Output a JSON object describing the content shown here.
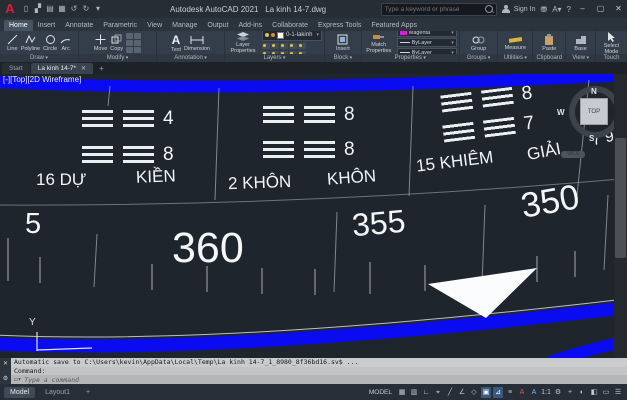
{
  "titlebar": {
    "logo": "A",
    "app_title": "Autodesk AutoCAD 2021",
    "doc_title": "La kinh 14-7.dwg",
    "search_placeholder": "Type a keyword or phrase",
    "sign_in_label": "Sign In",
    "window": {
      "minimize": "–",
      "maximize": "▢",
      "close": "✕"
    },
    "qat_icons": [
      {
        "name": "new-file-icon",
        "glyph": "▯"
      },
      {
        "name": "open-folder-icon",
        "glyph": "▞"
      },
      {
        "name": "save-icon",
        "glyph": "▤"
      },
      {
        "name": "plot-icon",
        "glyph": "▦"
      },
      {
        "name": "undo-icon",
        "glyph": "↺"
      },
      {
        "name": "redo-icon",
        "glyph": "↻"
      },
      {
        "name": "qat-dropdown-icon",
        "glyph": "▾"
      }
    ]
  },
  "ribbon": {
    "tabs": [
      {
        "label": "Home",
        "active": true
      },
      {
        "label": "Insert"
      },
      {
        "label": "Annotate"
      },
      {
        "label": "Parametric"
      },
      {
        "label": "View"
      },
      {
        "label": "Manage"
      },
      {
        "label": "Output"
      },
      {
        "label": "Add-ins"
      },
      {
        "label": "Collaborate"
      },
      {
        "label": "Express Tools"
      },
      {
        "label": "Featured Apps"
      }
    ],
    "draw": {
      "label": "Draw",
      "line": "Line",
      "polyline": "Polyline",
      "circle": "Circle",
      "arc": "Arc"
    },
    "modify": {
      "label": "Modify",
      "move": "Move",
      "copy": "Copy"
    },
    "annotation": {
      "label": "Annotation",
      "text_icon": "A",
      "text": "Text",
      "dimension": "Dimension"
    },
    "layers": {
      "label": "Layers",
      "layer_properties": "Layer Properties",
      "current_layer": "0-1-lakinh"
    },
    "block": {
      "label": "Block",
      "insert": "Insert"
    },
    "properties": {
      "label": "Properties",
      "match": "Match Properties",
      "color": "Magenta",
      "linetype": "ByLayer",
      "lineweight": "ByLayer"
    },
    "groups": {
      "label": "Groups",
      "group": "Group"
    },
    "utilities": {
      "label": "Utilities",
      "measure": "Measure"
    },
    "clipboard": {
      "label": "Clipboard",
      "paste": "Paste"
    },
    "view": {
      "label": "View",
      "base": "Base"
    },
    "touch": {
      "label": "Touch",
      "select": "Select Mode"
    }
  },
  "file_tabs": {
    "start": "Start",
    "document": "La kinh 14-7*",
    "close": "✕",
    "new_tab": "+"
  },
  "canvas": {
    "viewport_controls": "[-][Top][2D Wireframe]",
    "viewcube": {
      "n": "N",
      "s": "S",
      "e": "E",
      "w": "W",
      "top": "TOP",
      "wcs": "WCS"
    },
    "hexagram_groups": [
      {
        "row1_value": "4",
        "row2_value": "8",
        "label_left": "16 DỰ",
        "label_right": "KIỀN"
      },
      {
        "row1_value": "8",
        "row2_value": "8",
        "label_left": "2 KHÔN",
        "label_right": "KHÔN"
      },
      {
        "row1_value": "8",
        "row2_value": "7",
        "label_left": "15 KHIÊM",
        "label_right": "GIẢI"
      }
    ],
    "edge_values": "7 9",
    "degrees": {
      "d5": "5",
      "d360": "360",
      "d355": "355",
      "d350": "350"
    },
    "ucs_y": "Y"
  },
  "command": {
    "close_icon": "✕",
    "tools_icon": "⚙",
    "line1": "Automatic save to C:\\Users\\kevin\\AppData\\Local\\Temp\\La kinh 14-7_1_8980_8f36bd16.sv$ ...",
    "prompt": "Command:",
    "placeholder": "Type a command"
  },
  "statusbar": {
    "model_tab": "Model",
    "layout_tab": "Layout1",
    "new_layout": "+",
    "model_space": "MODEL",
    "icons": [
      {
        "name": "grid-icon",
        "glyph": "▦"
      },
      {
        "name": "snap-icon",
        "glyph": "▥"
      },
      {
        "name": "inference-icon",
        "glyph": "∟"
      },
      {
        "name": "dynamic-input-icon",
        "glyph": "⌖"
      },
      {
        "name": "ortho-icon",
        "glyph": "╱"
      },
      {
        "name": "polar-tracking-icon",
        "glyph": "∠"
      },
      {
        "name": "isodraft-icon",
        "glyph": "◇"
      },
      {
        "name": "osnap-icon",
        "glyph": "▣",
        "active": true
      },
      {
        "name": "osnap-tracking-icon",
        "glyph": "⊿",
        "active": true
      },
      {
        "name": "lineweight-icon",
        "glyph": "≡"
      },
      {
        "name": "annotation-visibility-icon",
        "glyph": "A",
        "accent": "#d35b5b"
      },
      {
        "name": "autoscale-icon",
        "glyph": "A",
        "accent": "#7fb2e8"
      },
      {
        "name": "annotation-scale-icon",
        "glyph": "1:1"
      },
      {
        "name": "workspace-gear-icon",
        "glyph": "⚙"
      },
      {
        "name": "annotation-monitor-icon",
        "glyph": "+"
      },
      {
        "name": "isolate-icon",
        "glyph": "◐"
      },
      {
        "name": "hardware-acceleration-icon",
        "glyph": "◧"
      },
      {
        "name": "clean-screen-icon",
        "glyph": "▭"
      },
      {
        "name": "customization-icon",
        "glyph": "☰"
      }
    ]
  }
}
